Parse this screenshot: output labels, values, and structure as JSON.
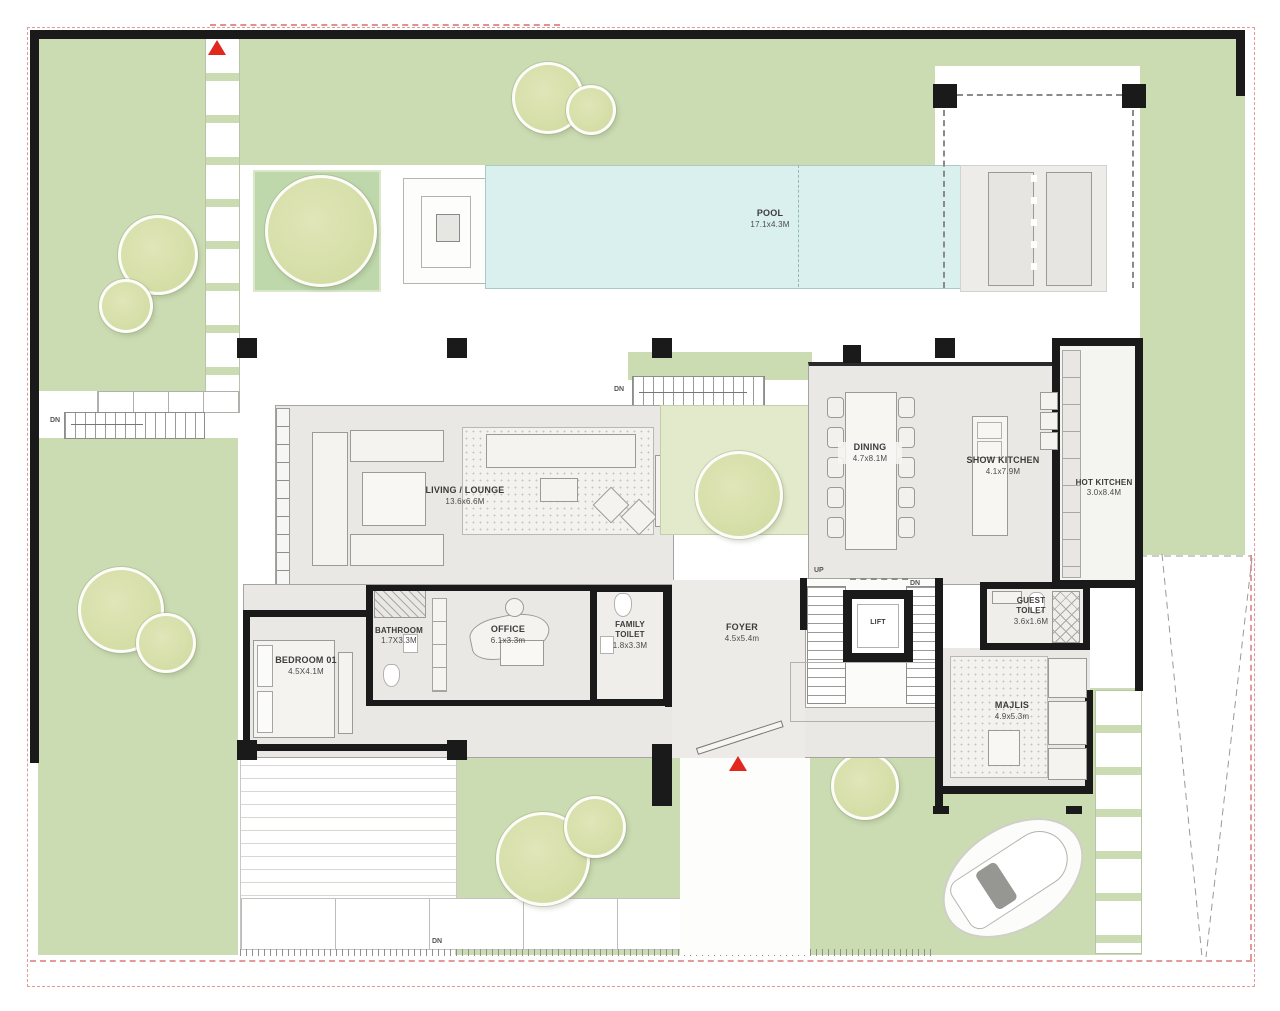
{
  "rooms": {
    "pool": {
      "name": "POOL",
      "dims": "17.1x4.3M"
    },
    "living": {
      "name": "LIVING / LOUNGE",
      "dims": "13.6x6.6M"
    },
    "dining": {
      "name": "DINING",
      "dims": "4.7x8.1M"
    },
    "show_kitchen": {
      "name": "SHOW KITCHEN",
      "dims": "4.1x7.9M"
    },
    "hot_kitchen": {
      "name": "HOT KITCHEN",
      "dims": "3.0x8.4M"
    },
    "bedroom01": {
      "name": "BEDROOM 01",
      "dims": "4.5X4.1M"
    },
    "bathroom": {
      "name": "BATHROOM",
      "dims": "1.7X3.3M"
    },
    "office": {
      "name": "OFFICE",
      "dims": "6.1x3.3m"
    },
    "family_toilet": {
      "name": "FAMILY TOILET",
      "dims": "1.8x3.3M"
    },
    "foyer": {
      "name": "FOYER",
      "dims": "4.5x5.4m"
    },
    "lift": {
      "name": "LIFT",
      "dims": ""
    },
    "guest_toilet": {
      "name": "GUEST TOILET",
      "dims": "3.6x1.6M"
    },
    "majlis": {
      "name": "MAJLIS",
      "dims": "4.9x5.3m"
    }
  },
  "stairs": {
    "up": "UP",
    "dn": "DN"
  },
  "colors": {
    "grass": "#cbdcb2",
    "grass_light": "#e2eacb",
    "tree": "#d3dca4",
    "pool": "#d9f0ef",
    "floor": "#e9e8e4",
    "wall": "#1a1a1a",
    "red": "#e0281e",
    "boundary_red": "#e49a9a"
  }
}
